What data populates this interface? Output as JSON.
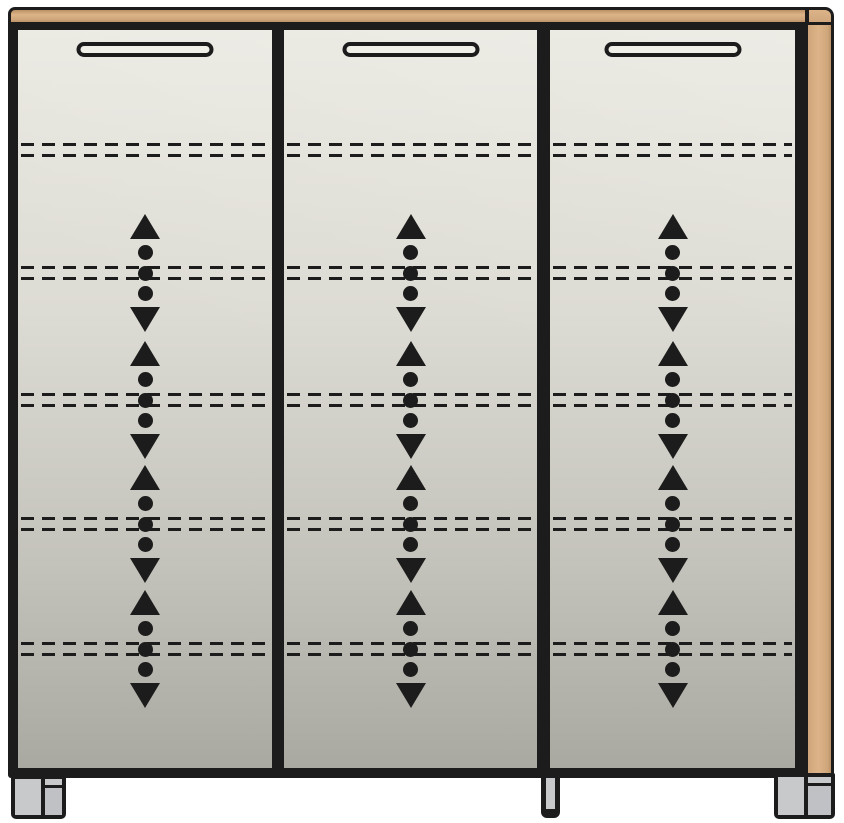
{
  "title": "Three-door cabinet with adjustable shelves - front elevation diagram",
  "canvas": {
    "width": 844,
    "height": 823
  },
  "colors": {
    "line": "#1c1c1c",
    "wood-light": "#ddb388",
    "wood-mid": "#cfa67b",
    "wood-dark": "#bb9166",
    "door-top": "#e9e8e0",
    "door-bottom": "#a9a9a1",
    "handle-fill": "#f1f0e8",
    "foot-light": "#c7c9cb",
    "foot-mid": "#bfc1c4",
    "background": "#ffffff"
  },
  "cabinet": {
    "top_panel": {
      "label": "wood top panel"
    },
    "side_panel": {
      "label": "wood side panel right"
    },
    "door_area": {
      "top": 8,
      "height": 738
    },
    "doors": [
      {
        "name": "left door",
        "x": 10,
        "width": 254
      },
      {
        "name": "middle door",
        "x": 276,
        "width": 253
      },
      {
        "name": "right door",
        "x": 542,
        "width": 245
      }
    ],
    "handle": {
      "style": "recessed grip",
      "width": 137,
      "height": 15,
      "top": 12
    },
    "shelf_rows": {
      "dashed_pair_centers": [
        120,
        243,
        370,
        494,
        619
      ],
      "pair_offsets": [
        -7,
        4
      ],
      "adjustable_centers": [
        243,
        370,
        494,
        619
      ]
    },
    "adjust_indicator": {
      "meaning": "shelf height adjustable up/down",
      "parts": [
        "triangle-up",
        "dot",
        "dot",
        "dot",
        "triangle-down"
      ]
    },
    "feet": [
      {
        "name": "left foot",
        "style": "double-block"
      },
      {
        "name": "center foot",
        "style": "slim"
      },
      {
        "name": "right foot",
        "style": "double-block"
      }
    ]
  }
}
